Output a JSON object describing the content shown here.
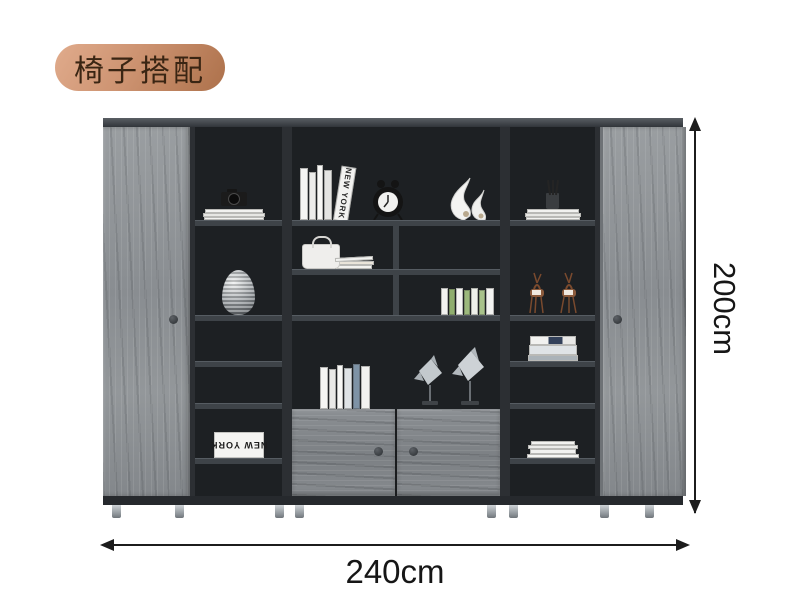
{
  "badge": {
    "label": "椅子搭配"
  },
  "dimension_annotations": {
    "height": "200cm",
    "width": "240cm"
  },
  "decor_texts": {
    "new_york_spine": "NEW YORK",
    "new_york_box": "NEW YORK"
  },
  "colors": {
    "badge_bg_start": "#e0ab8c",
    "badge_bg_end": "#ad714b",
    "badge_text": "#3a2513",
    "wood": "#8e9296",
    "wood_dark": "#7f8487",
    "interior": "#1d2023",
    "frame": "#2c2f33",
    "shelf_board": "#3e4348",
    "top_band": "#3c4145",
    "door_knob": "#3e4246",
    "leg": "#a8adb2",
    "dim_line": "#1c1c1c"
  },
  "cabinet_items": {
    "left_door": "gray wood sliding door with knob",
    "right_door": "gray wood sliding door with knob",
    "left_column": [
      "black camera on magazine stack",
      "silver ribbed vase",
      "",
      "",
      "NEW YORK book box (upside down)",
      ""
    ],
    "center": {
      "row1": [
        "white books leaning with NEW YORK spine",
        "black twin-bell alarm clock",
        "white abstract swirl sculpture"
      ],
      "row2": [
        "white handbag ornament with letters",
        ""
      ],
      "row3": [
        "",
        "green and white book spines"
      ],
      "row4": [
        "white and blue standing books",
        "two silver angelfish sculptures on stands"
      ],
      "row5": [
        "double gray wood doors with round knobs"
      ]
    },
    "right_column": [
      "pen cup with brushes on white books",
      "two copper deer figurines",
      "horizontal book stack",
      "",
      "white paper stack",
      ""
    ]
  }
}
